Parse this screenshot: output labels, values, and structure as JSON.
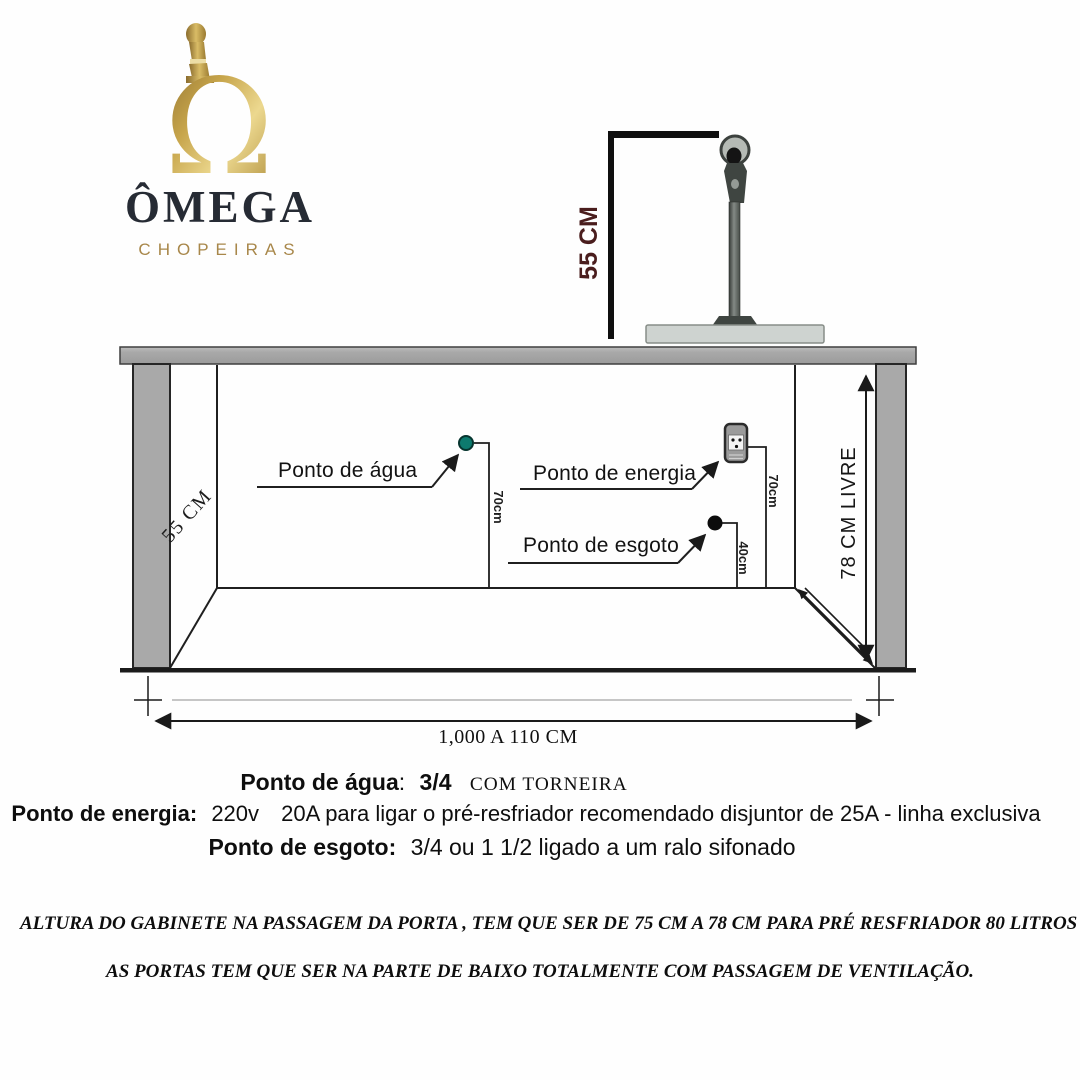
{
  "brand": {
    "glyph": "Ω",
    "name": "ÔMEGA",
    "subtitle": "CHOPEIRAS",
    "gold": "#b3913f",
    "dark": "#262b34"
  },
  "tower": {
    "icon": "beer-tower",
    "height_label": "55 CM",
    "label_color": "#4a1d1d"
  },
  "cabinet": {
    "depth_label": "55 CM",
    "clearance_label": "78 CM LIVRE",
    "width_label": "1,000 A 110 CM",
    "points": {
      "water": {
        "label": "Ponto de água",
        "riser_label": "70cm",
        "icon": "teal-dot",
        "dot_color": "#0d7a6e"
      },
      "energy": {
        "label": "Ponto de energia",
        "riser_label": "70cm",
        "icon": "power-outlet-3pin"
      },
      "drain": {
        "label": "Ponto de esgoto",
        "riser_label": "40cm",
        "icon": "black-dot"
      }
    }
  },
  "specs": {
    "water": {
      "label": "Ponto de água",
      "colon": ":",
      "value": "3/4",
      "suffix": "COM TORNEIRA"
    },
    "energy": {
      "label": "Ponto de energia:",
      "volts": "220v",
      "rest": "20A para ligar o pré-resfriador recomendado disjuntor de 25A - linha exclusiva"
    },
    "drain": {
      "label": "Ponto de esgoto:",
      "rest": "3/4 ou 1 1/2 ligado a um ralo sifonado"
    }
  },
  "notes": {
    "line1": "ALTURA DO GABINETE NA PASSAGEM DA PORTA , TEM QUE SER DE 75 CM A 78 CM PARA PRÉ RESFRIADOR 80 LITROS HORAS 40X40 x 73",
    "line2": "AS PORTAS TEM QUE SER NA PARTE DE BAIXO TOTALMENTE COM PASSAGEM DE VENTILAÇÃO."
  },
  "colors": {
    "line": "#1c1c1c",
    "cabinet_gray": "#a9a9a9",
    "teal": "#0d7a6e",
    "maroon": "#4a1d1d"
  }
}
